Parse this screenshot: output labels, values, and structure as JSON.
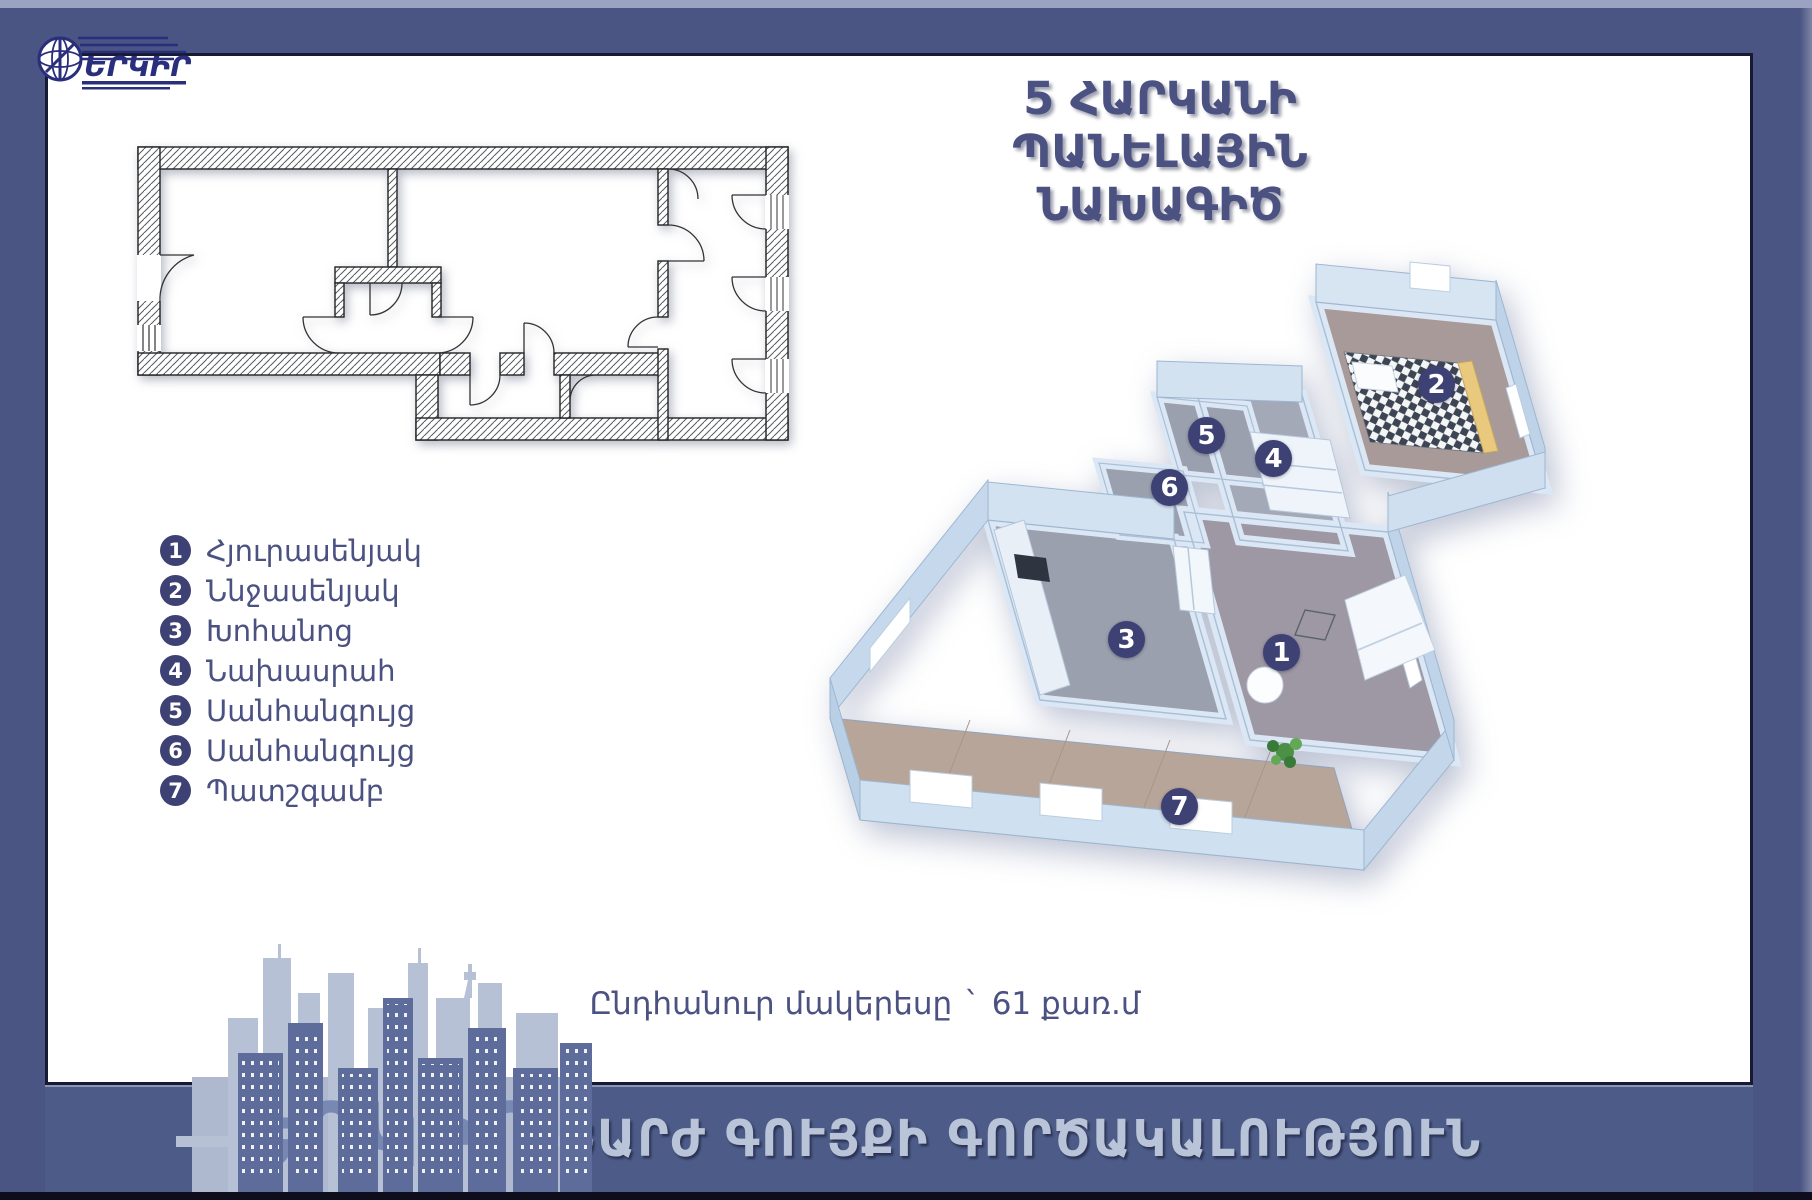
{
  "brand": {
    "name": "ԵՐԿԻՐ"
  },
  "title": {
    "line1": "5 ՀԱՐԿԱՆԻ ՊԱՆԵԼԱՅԻՆ",
    "line2": "ՆԱԽԱԳԻԾ"
  },
  "legend": {
    "items": [
      {
        "number": "1",
        "label": "Հյուրասենյակ"
      },
      {
        "number": "2",
        "label": "Ննջասենյակ"
      },
      {
        "number": "3",
        "label": "Խոհանոց"
      },
      {
        "number": "4",
        "label": "Նախասրահ"
      },
      {
        "number": "5",
        "label": "Սանհանգույց"
      },
      {
        "number": "6",
        "label": "Սանհանգույց"
      },
      {
        "number": "7",
        "label": "Պատշգամբ"
      }
    ]
  },
  "plan3d": {
    "markers": [
      {
        "number": "1"
      },
      {
        "number": "2"
      },
      {
        "number": "3"
      },
      {
        "number": "4"
      },
      {
        "number": "5"
      },
      {
        "number": "6"
      },
      {
        "number": "7"
      }
    ]
  },
  "area": {
    "label": "Ընդհանուր մակերեսը",
    "separator": "`",
    "value": "61 քառ.մ"
  },
  "footer": {
    "agency": "ԱՆՇԱՐԺ ԳՈՒՅՔԻ ԳՈՐԾԱԿԱԼՈՒԹՅՈՒՆ",
    "watermark": "ԵՐԿԻՐ"
  },
  "colors": {
    "frame": "#4a5583",
    "accent": "#3e4173",
    "text": "#4b5282",
    "banner_text": "#b9c4d8"
  }
}
